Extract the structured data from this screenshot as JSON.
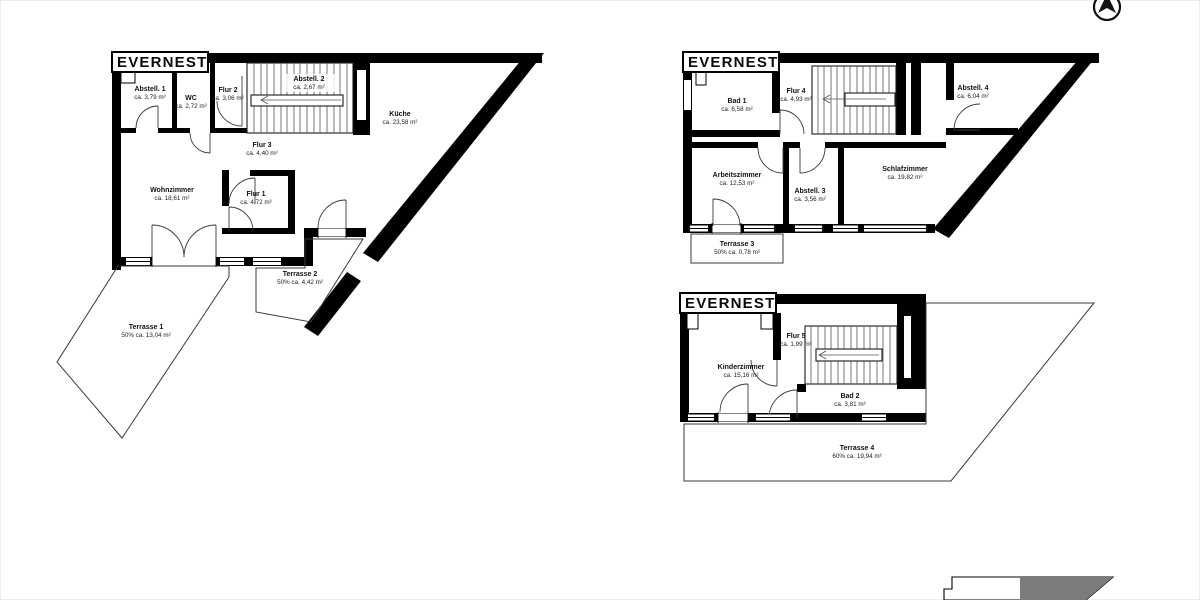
{
  "colors": {
    "wall": "#000000",
    "background": "#ffffff",
    "keyplan_gray": "#7c7c7c"
  },
  "north_arrow": {
    "meaning": "north"
  },
  "plans": [
    {
      "title": "EVERNEST",
      "rooms": [
        {
          "name": "Abstell. 1",
          "area": "ca. 3,79 m²"
        },
        {
          "name": "WC",
          "area": "ca. 2,72 m²"
        },
        {
          "name": "Flur 2",
          "area": "ca. 3,06 m²"
        },
        {
          "name": "Abstell. 2",
          "area": "ca. 2,67 m²"
        },
        {
          "name": "Küche",
          "area": "ca. 23,58 m²"
        },
        {
          "name": "Flur 3",
          "area": "ca. 4,40 m²"
        },
        {
          "name": "Wohnzimmer",
          "area": "ca. 18,61 m²"
        },
        {
          "name": "Flur 1",
          "area": "ca. 4,72 m²"
        },
        {
          "name": "Terrasse 2",
          "area": "50% ca. 4,42 m²"
        },
        {
          "name": "Terrasse 1",
          "area": "50% ca. 13,04 m²"
        }
      ]
    },
    {
      "title": "EVERNEST",
      "rooms": [
        {
          "name": "Bad 1",
          "area": "ca. 6,58 m²"
        },
        {
          "name": "Flur 4",
          "area": "ca. 4,93 m²"
        },
        {
          "name": "Abstell. 4",
          "area": "ca. 6,04 m²"
        },
        {
          "name": "Arbeitszimmer",
          "area": "ca. 12,53 m²"
        },
        {
          "name": "Abstell. 3",
          "area": "ca. 3,56 m²"
        },
        {
          "name": "Schlafzimmer",
          "area": "ca. 19,82 m²"
        },
        {
          "name": "Terrasse 3",
          "area": "50% ca. 0,78 m²"
        }
      ]
    },
    {
      "title": "EVERNEST",
      "rooms": [
        {
          "name": "Flur 5",
          "area": "ca. 1,99 m²"
        },
        {
          "name": "Kinderzimmer",
          "area": "ca. 15,16 m²"
        },
        {
          "name": "Bad 2",
          "area": "ca. 3,81 m²"
        },
        {
          "name": "Terrasse 4",
          "area": "60% ca. 19,94 m²"
        }
      ]
    }
  ]
}
